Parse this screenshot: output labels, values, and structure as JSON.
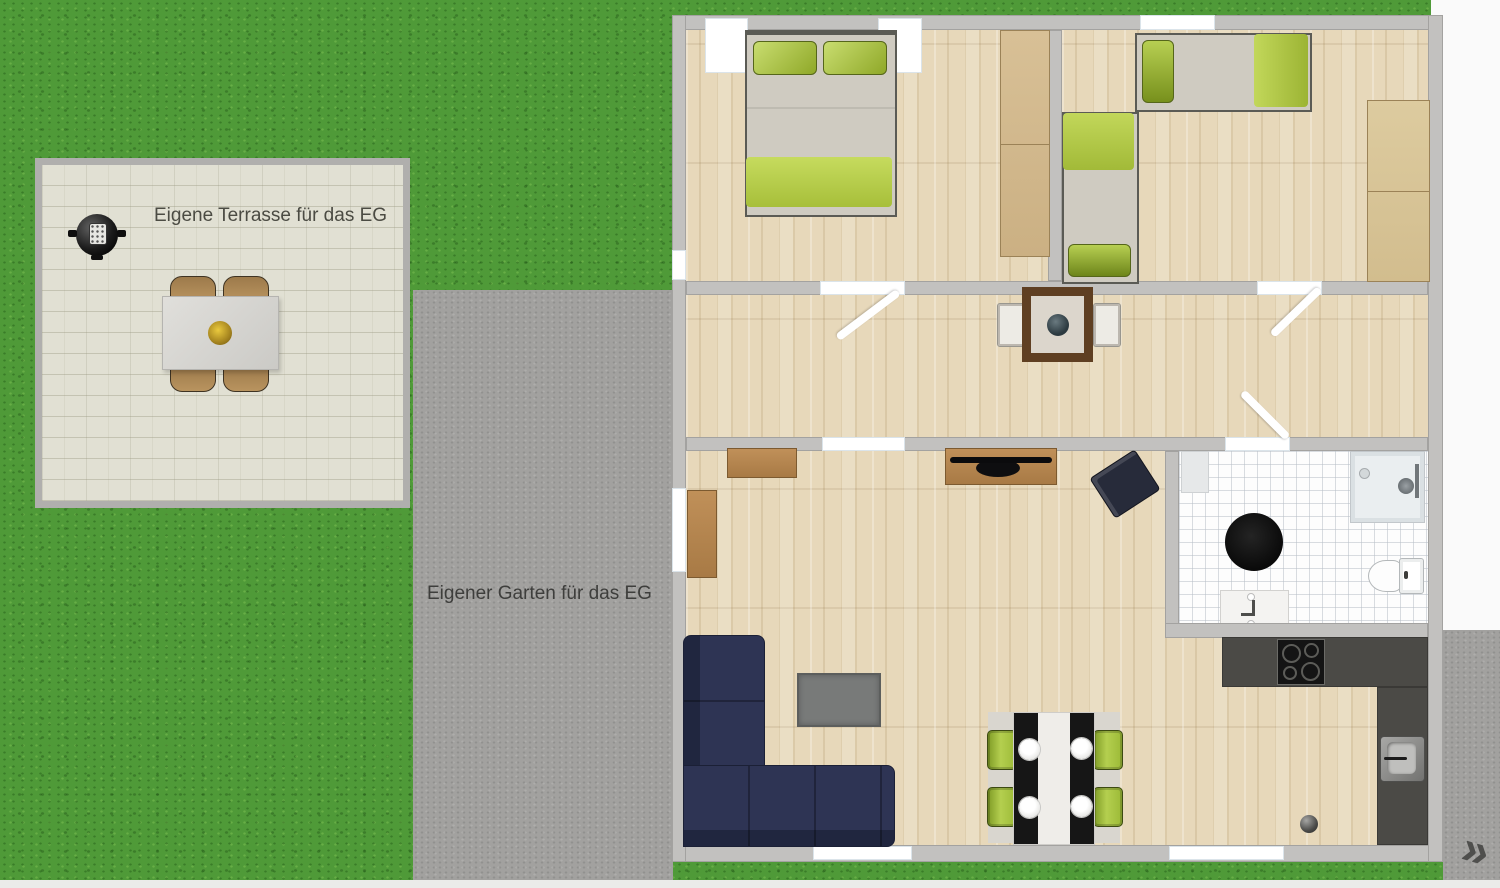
{
  "labels": {
    "terrace": "Eigene Terrasse für das EG",
    "garden": "Eigener Garten für das EG"
  },
  "nav": {
    "next_arrow": "»"
  },
  "plan": {
    "floor": "EG",
    "view": "top-down-floor-plan",
    "rooms": [
      {
        "name": "bedroom-1",
        "furniture": [
          "double-bed",
          "wardrobe"
        ]
      },
      {
        "name": "bedroom-2",
        "furniture": [
          "single-bed-horizontal",
          "single-bed-vertical",
          "wardrobe"
        ]
      },
      {
        "name": "hallway",
        "furniture": [
          "bistro-table",
          "chair-left",
          "chair-right"
        ]
      },
      {
        "name": "living-room",
        "furniture": [
          "corner-sofa",
          "coffee-table",
          "tv-lowboard",
          "tv",
          "sideboard",
          "cabinet",
          "armchair",
          "dining-table",
          "dining-chairs-x4",
          "rug"
        ]
      },
      {
        "name": "kitchen",
        "furniture": [
          "l-shaped-counter",
          "cooktop",
          "sink"
        ]
      },
      {
        "name": "bathroom",
        "furniture": [
          "shower",
          "toilet",
          "washbasin",
          "round-rug",
          "shelf"
        ]
      },
      {
        "name": "terrace",
        "furniture": [
          "kettle-grill",
          "garden-table",
          "garden-chairs-x4"
        ]
      }
    ]
  },
  "colors": {
    "grass": "#4f9a38",
    "path": "#a2a19f",
    "terrace_surface": "#e1e0d3",
    "wall": "#c2c1bf",
    "wood_floor": "#e7d8ba",
    "bathroom_tile": "#fdfdfd",
    "accent_green": "#a9c23f",
    "sofa_navy": "#2d3352",
    "kitchen_counter": "#4b4a46",
    "furniture_wood": "#b5854f",
    "window_white": "#ffffff",
    "label_text": "#4a4a42"
  }
}
